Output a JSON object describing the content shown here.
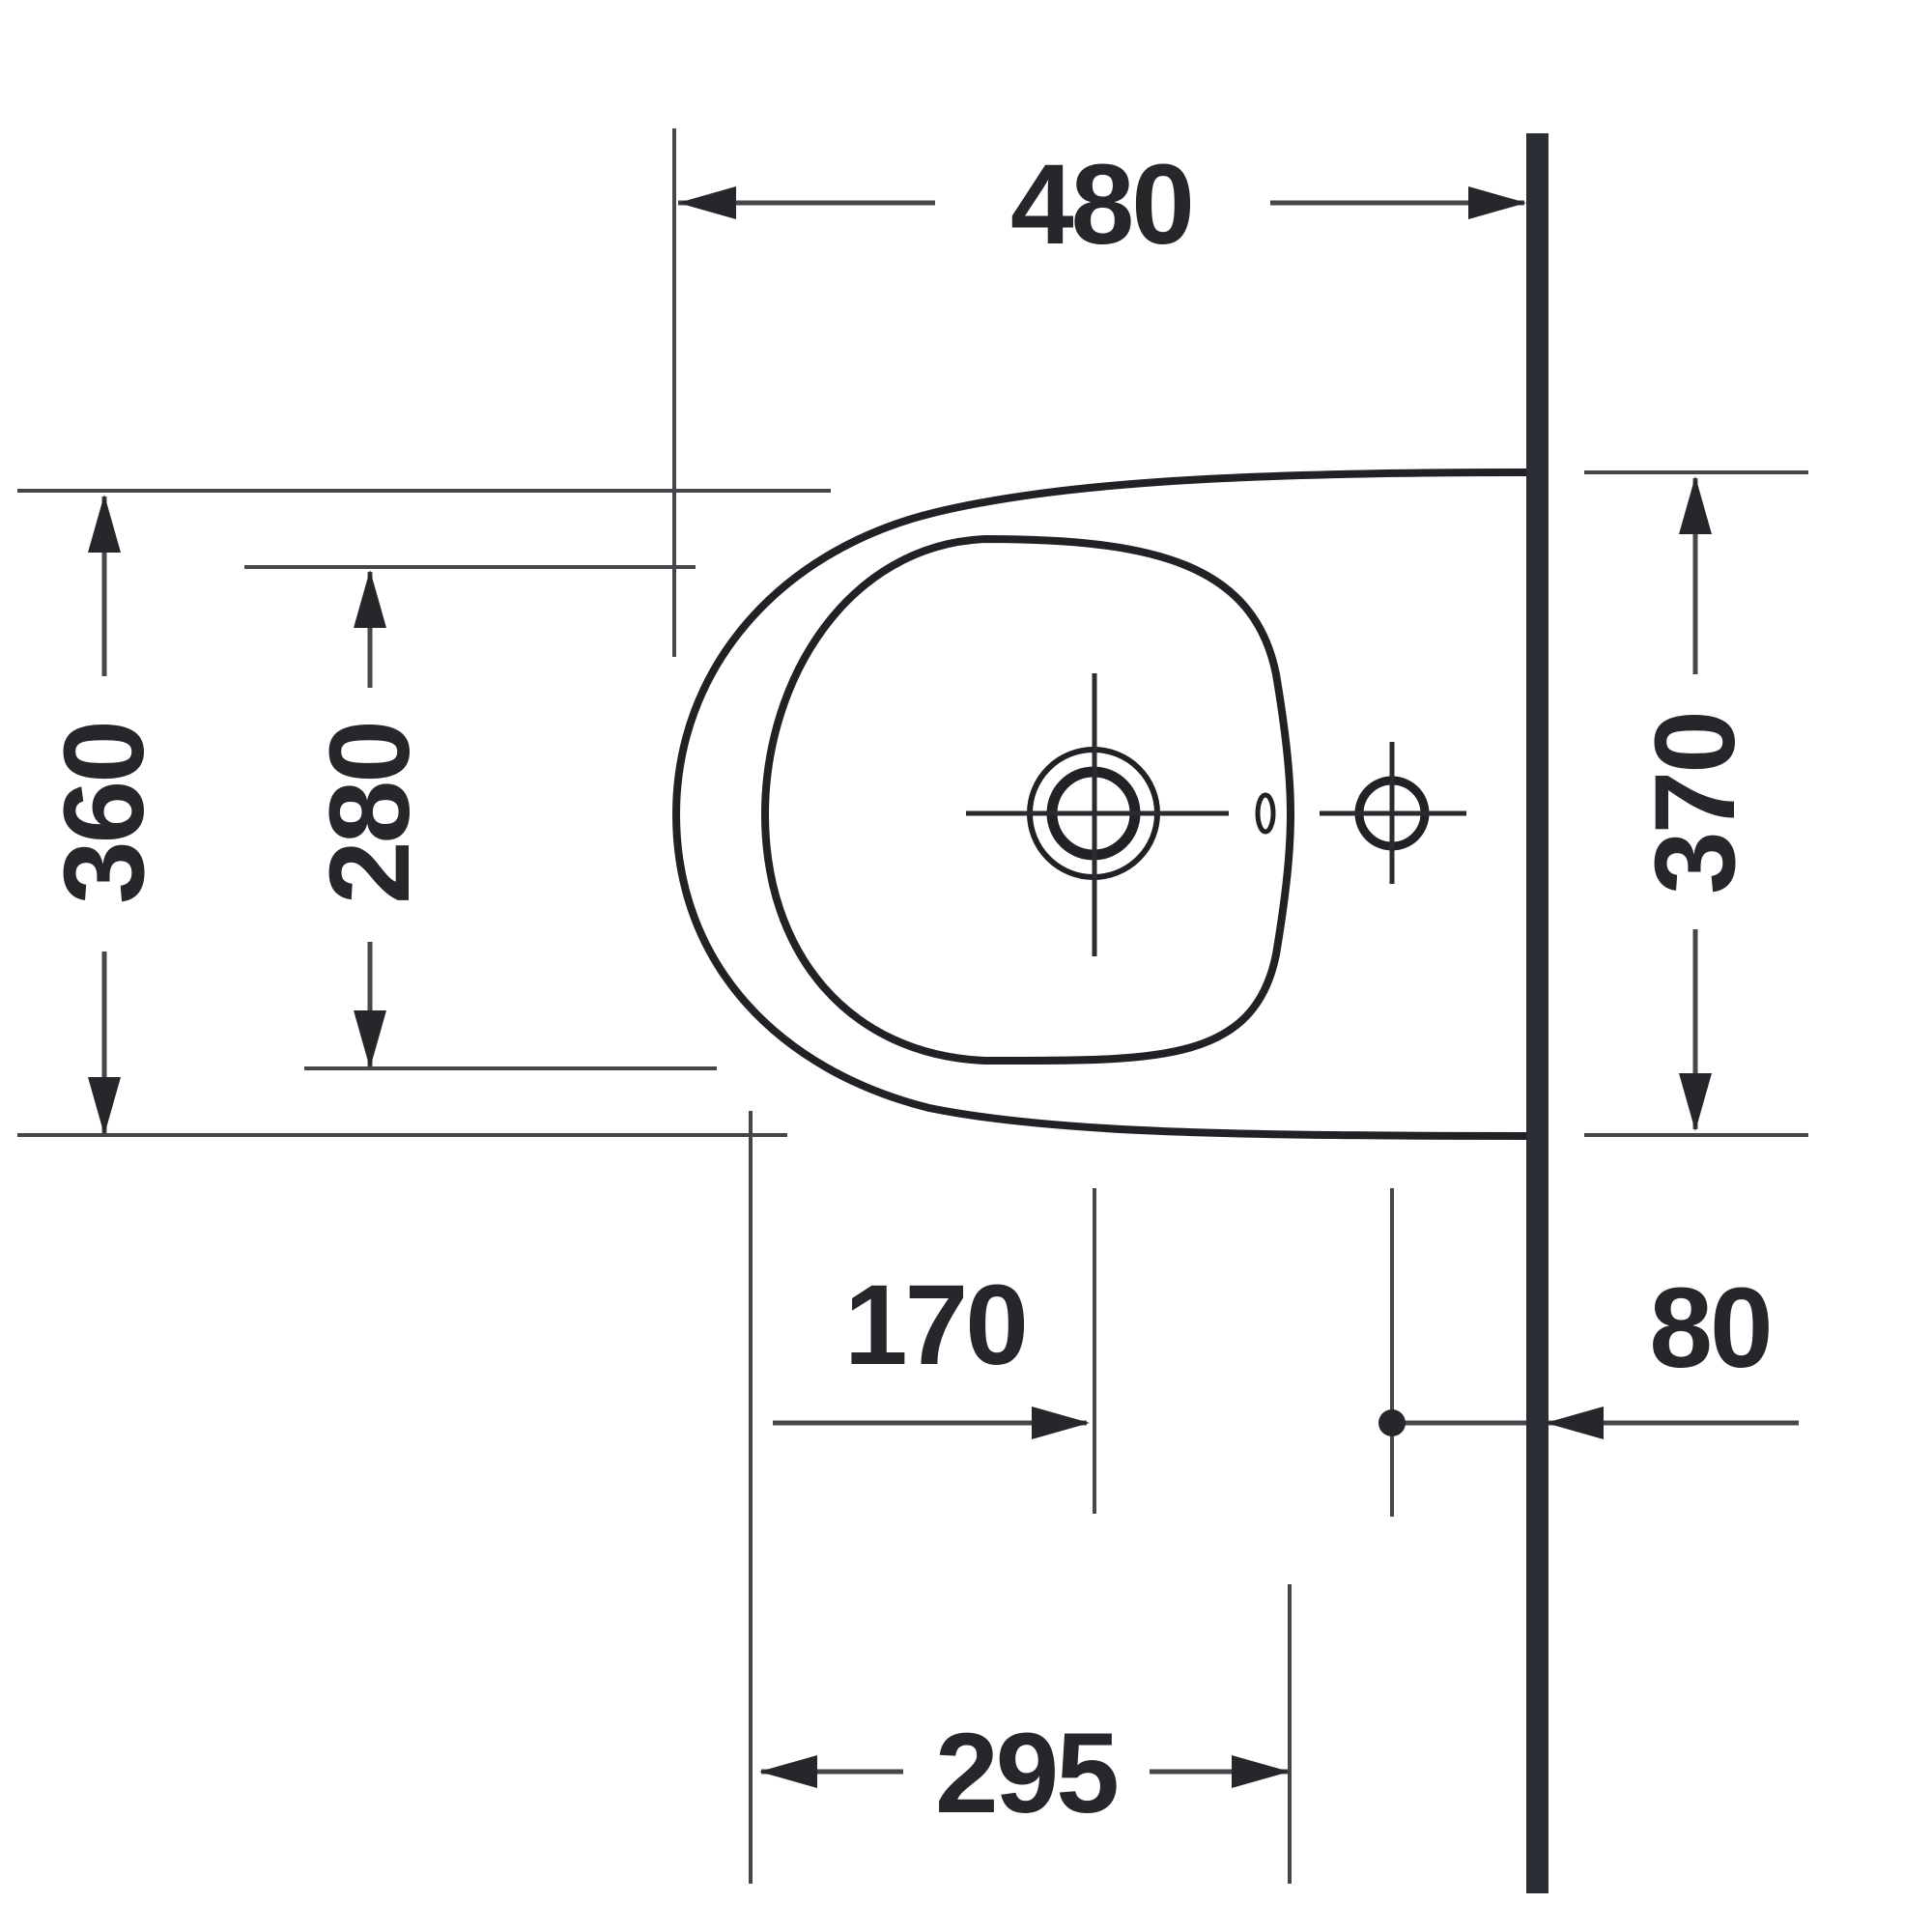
{
  "drawing": {
    "type": "technical-dimension-drawing",
    "subject": "wall-mounted bidet, top view",
    "units": "mm",
    "line_color": "#2a2a2f",
    "thin_line_color": "#46464b",
    "wall_color": "#2b2e34",
    "background": "#ffffff",
    "dimensions": {
      "depth_total": {
        "label": "480",
        "meaning": "front edge to wall"
      },
      "width_outer": {
        "label": "360",
        "meaning": "outer width at front"
      },
      "width_inner": {
        "label": "280",
        "meaning": "inner rim width"
      },
      "width_at_wall": {
        "label": "370",
        "meaning": "outer width at wall"
      },
      "drain_offset": {
        "label": "170",
        "meaning": "tap-hole centre from front reference"
      },
      "fixing_offset": {
        "label": "80",
        "meaning": "fixing point from wall"
      },
      "outlet_offset": {
        "label": "295",
        "meaning": "outlet reference from front reference"
      }
    }
  }
}
